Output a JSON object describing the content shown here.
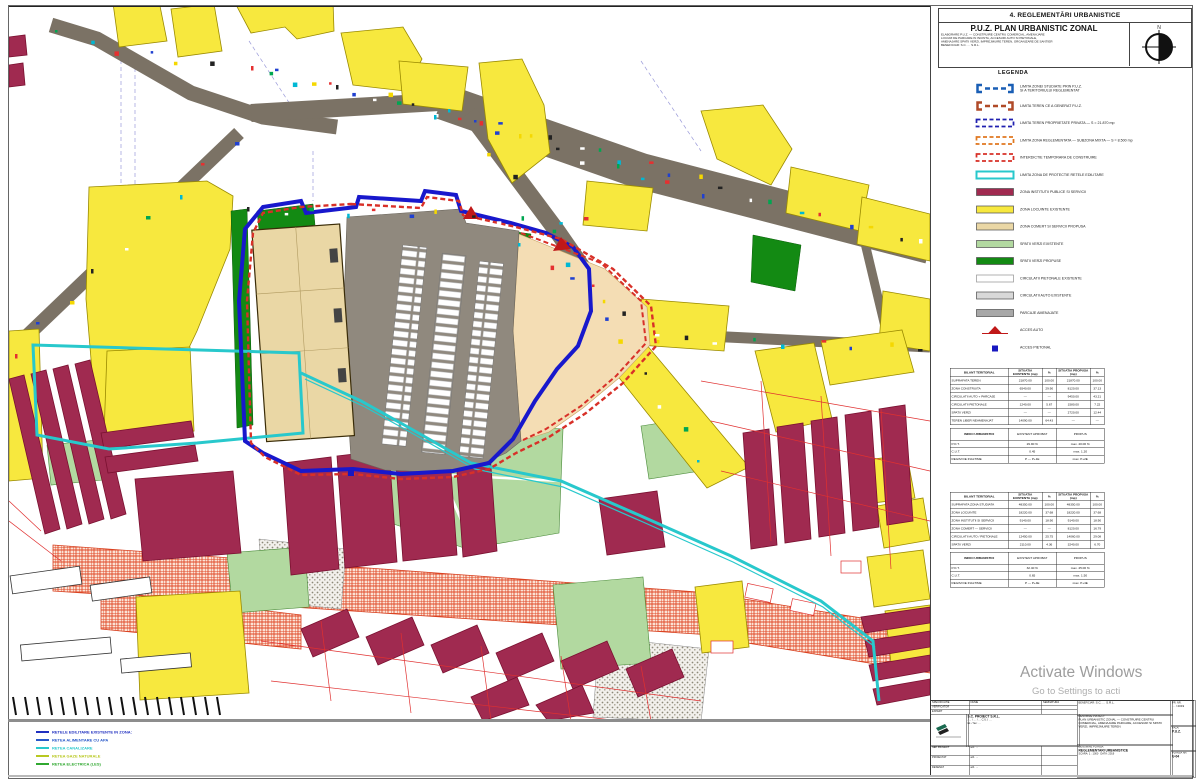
{
  "panel": {
    "header": "4. REGLEMENTĂRI URBANISTICE",
    "title": "P.U.Z.  PLAN URBANISTIC ZONAL",
    "subtitle": "ELABORARE P.U.Z. — CONSTRUIRE CENTRU COMERCIAL, AMENAJARE\nLOCURI DE PARCARE IN INCINTA, ACCESURI AUTO SI PIETONALE,\nAMENAJARE SPATII VERZI, IMPREJMUIRE TEREN, ORGANIZARE DE SANTIER\nBENEFICIAR: S.C. … S.R.L.",
    "compass_label": "N"
  },
  "legend": {
    "title": "LEGENDA",
    "items": [
      {
        "type": "bracket",
        "color": "#1a5fb5",
        "label": "LIMITA ZONEI STUDIATE PRIN P.U.Z.\nSI A TERITORIULUI REGLEMENTAT"
      },
      {
        "type": "bracket",
        "color": "#b04a28",
        "label": "LIMITA TEREN CE A GENERAT P.U.Z."
      },
      {
        "type": "dashrect",
        "color": "#2020b0",
        "label": "LIMITA TEREN PROPRIETATE PRIVATA — S = 21.870 mp"
      },
      {
        "type": "dashrect",
        "color": "#e07820",
        "label": "LIMITA ZONA REGLEMENTATA — SUBZONA MIXTA — S = 8.500 mp"
      },
      {
        "type": "dashrect",
        "color": "#d83028",
        "label": "INTERDICTIE TEMPORARA DE CONSTRUIRE"
      },
      {
        "type": "cyanrect",
        "color": "#28c8cc",
        "label": "LIMITA ZONA DE PROTECTIE RETELE EDILITARE"
      },
      {
        "type": "rect",
        "color": "#a02a50",
        "label": "ZONA INSTITUTII PUBLICE SI SERVICII"
      },
      {
        "type": "rect",
        "color": "#f7e83e",
        "label": "ZONA LOCUINTE EXISTENTE"
      },
      {
        "type": "rect",
        "color": "#ead7a5",
        "label": "ZONA COMERT SI SERVICII PROPUSA"
      },
      {
        "type": "rect",
        "color": "#b2d9a0",
        "label": "SPATII VERZI EXISTENTE"
      },
      {
        "type": "rect",
        "color": "#138a13",
        "label": "SPATII VERZI PROPUSE"
      },
      {
        "type": "rect",
        "color": "#ffffff",
        "label": "CIRCULATII PIETONALE EXISTENTE"
      },
      {
        "type": "rect",
        "color": "#d8d8d8",
        "label": "CIRCULATII AUTO EXISTENTE"
      },
      {
        "type": "rect",
        "color": "#a8a8a8",
        "label": "PARCAJE AMENAJATE"
      },
      {
        "type": "triangle",
        "color": "#c01818",
        "label": "ACCES AUTO"
      },
      {
        "type": "dot",
        "color": "#1818c0",
        "label": "ACCES PIETONAL"
      }
    ]
  },
  "tables": [
    {
      "headers": [
        "BILANT TERITORIAL",
        "SITUATIA EXISTENTA (mp)",
        "%",
        "SITUATIA PROPUSA (mp)",
        "%"
      ],
      "rows": [
        [
          "SUPRAFATA TEREN",
          "21870.00",
          "100.00",
          "21870.00",
          "100.00"
        ],
        [
          "ZONA CONSTRUITA",
          "6540.00",
          "29.90",
          "8120.00",
          "37.13"
        ],
        [
          "CIRCULATII AUTO + PARCAJE",
          "—",
          "—",
          "9450.00",
          "43.21"
        ],
        [
          "CIRCULATII PIETONALE",
          "1240.00",
          "5.67",
          "1580.00",
          "7.22"
        ],
        [
          "SPATII VERZI",
          "—",
          "—",
          "2720.00",
          "12.44"
        ],
        [
          "TEREN LIBER NEAMENAJAT",
          "14090.00",
          "64.43",
          "—",
          "—"
        ]
      ],
      "indici": {
        "title": "INDICI URBANISTICI",
        "cols": [
          "EXISTENT APROBAT",
          "PROPUS"
        ],
        "rows": [
          [
            "P.O.T.",
            "29.90 %",
            "max. 40.00 %"
          ],
          [
            "C.U.T.",
            "0.45",
            "max. 1.20"
          ]
        ],
        "footer": [
          "REGIM DE INALTIME",
          "P — P+1E",
          "max. P+2E"
        ]
      }
    },
    {
      "headers": [
        "BILANT TERITORIAL",
        "SITUATIA EXISTENTA (mp)",
        "%",
        "SITUATIA PROPUSA (mp)",
        "%"
      ],
      "rows": [
        [
          "SUPRAFATA ZONA STUDIATA",
          "48350.00",
          "100.00",
          "48350.00",
          "100.00"
        ],
        [
          "ZONA LOCUINTE",
          "18220.00",
          "37.68",
          "18220.00",
          "37.68"
        ],
        [
          "ZONA INSTITUTII SI SERVICII",
          "9140.00",
          "18.90",
          "9140.00",
          "18.90"
        ],
        [
          "ZONA COMERT — SERVICII",
          "—",
          "—",
          "8120.00",
          "16.79"
        ],
        [
          "CIRCULATII AUTO / PIETONALE",
          "12450.00",
          "25.75",
          "14060.00",
          "29.08"
        ],
        [
          "SPATII VERZI",
          "2110.00",
          "4.36",
          "3240.00",
          "6.70"
        ]
      ],
      "indici": {
        "title": "INDICI URBANISTICI",
        "cols": [
          "EXISTENT APROBAT",
          "PROPUS"
        ],
        "rows": [
          [
            "P.O.T.",
            "32.40 %",
            "max. 45.00 %"
          ],
          [
            "C.U.T.",
            "0.65",
            "max. 1.50"
          ]
        ],
        "footer": [
          "REGIM DE INALTIME",
          "P — P+4E",
          "max. P+4E"
        ]
      }
    }
  ],
  "watermark": {
    "line1": "Activate Windows",
    "line2": "Go to Settings to acti"
  },
  "cartouche": {
    "spec_header": [
      "SPECIFICATIE",
      "NUME",
      "SEMNATURA"
    ],
    "spec_top_rows": [
      [
        "VERIFICATOR",
        "",
        ""
      ],
      [
        "EXPERT",
        "",
        ""
      ]
    ],
    "spec_rows": [
      [
        "SEF PROIECT",
        "arh. …",
        ""
      ],
      [
        "PROIECTAT",
        "arh. …",
        ""
      ],
      [
        "DESENAT",
        "arh. …",
        ""
      ]
    ],
    "firm": "S.C. PROIECT S.R.L.",
    "firm_sub": "J… / … / …   C.U.I. …",
    "firm_sub2": "tel. / fax: …",
    "beneficiar_label": "BENEFICIAR:",
    "beneficiar": "S.C. … S.R.L.",
    "project_label": "DENUMIRE PROIECT:",
    "project_name": "PLAN URBANISTIC ZONAL — CONSTRUIRE CENTRU COMERCIAL, AMENAJARE PARCARE, ACCESURI SI SPATII VERZI, IMPREJMUIRE TEREN",
    "plansa_label": "DENUMIRE PLANSA:",
    "plansa_name": "REGLEMENTARI URBANISTICE",
    "scara_label": "SCARA:",
    "scara": "1 : 1000",
    "data_label": "DATA:",
    "data": "2019",
    "proiect_nr_label": "PR. NR.",
    "proiect_nr": "… / 2019",
    "faza_label": "FAZA:",
    "faza": "P.U.Z.",
    "plansa_nr_label": "PLANSA NR.",
    "plansa_nr": "U-04"
  },
  "map_notes": {
    "lines": [
      {
        "color": "#2030c0",
        "text": "RETELE EDILITARE EXISTENTE IN ZONA:"
      },
      {
        "color": "#2858c8",
        "text": "RETEA ALIMENTARE CU APA"
      },
      {
        "color": "#28c8cc",
        "text": "RETEA CANALIZARE"
      },
      {
        "color": "#b8c820",
        "text": "RETEA GAZE NATURALE"
      },
      {
        "color": "#30a830",
        "text": "RETEA ELECTRICA (LES)"
      }
    ]
  }
}
